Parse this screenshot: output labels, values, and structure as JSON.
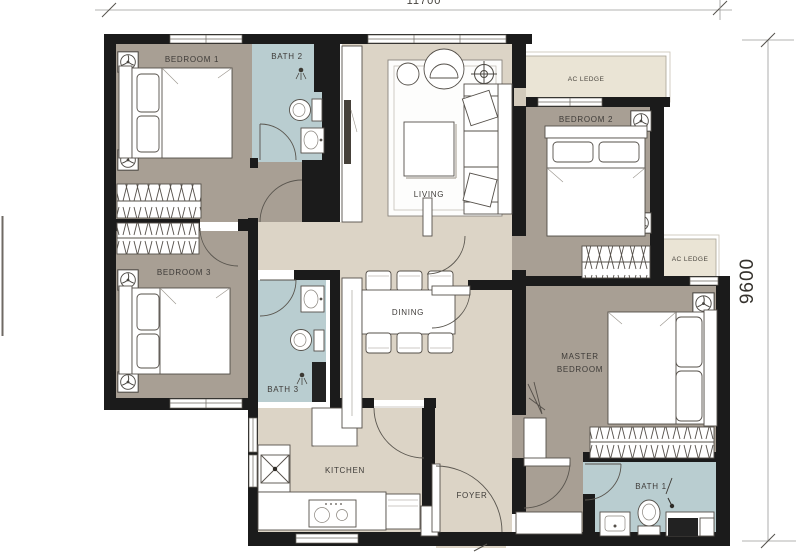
{
  "floorplan": {
    "rooms": {
      "bedroom1": "BEDROOM 1",
      "bath2": "BATH 2",
      "living": "LIVING",
      "bedroom2": "BEDROOM 2",
      "ac_ledge_top": "AC LEDGE",
      "bedroom3": "BEDROOM 3",
      "bath3": "BATH 3",
      "dining": "DINING",
      "ac_ledge_right": "AC LEDGE",
      "master_line1": "MASTER",
      "master_line2": "BEDROOM",
      "kitchen": "KITCHEN",
      "foyer": "FOYER",
      "bath1": "BATH 1"
    },
    "dimensions": {
      "width_top": "11700",
      "height_right": "9600"
    },
    "colors": {
      "wall": "#1b1b1b",
      "bedroom_floor": "#a89f94",
      "hall_floor": "#dcd4c6",
      "bath_floor": "#b9cdd0",
      "ledge": "#eae4d5",
      "rug": "#fdfdfc",
      "shower_dark": "#222222"
    }
  }
}
